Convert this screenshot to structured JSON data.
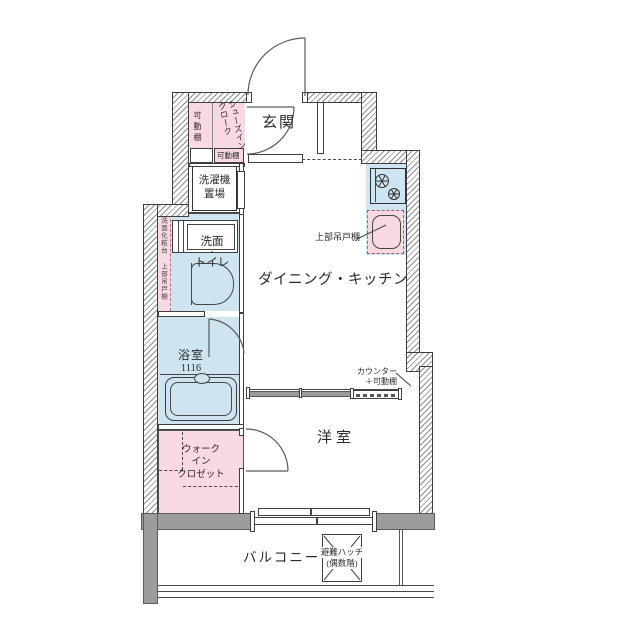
{
  "colors": {
    "room_blue": "#cfe4f1",
    "room_pink": "#f7d8e3",
    "wall_gray": "#9c9c9c",
    "line_dark": "#474747"
  },
  "labels": {
    "entrance": "玄関",
    "shoes_cloak_line1": "シューズイン",
    "shoes_cloak_line2": "クローク",
    "movable_shelf_vertical": "可動棚",
    "movable_shelf_box": "可動棚",
    "washer_line1": "洗濯機",
    "washer_line2": "置場",
    "vanity_strip": "洗面化粧台",
    "toilet_upper_cabinet_strip": "上部吊戸棚",
    "washroom_line1": "洗面",
    "washroom_dot": "・",
    "washroom_line2": "トイレ",
    "bathroom": "浴室",
    "bathroom_size": "1116",
    "dining_kitchen": "ダイニング・キッチン",
    "kitchen_upper_cabinet": "上部吊戸棚",
    "counter_line1": "カウンター",
    "counter_line2": "＋可動棚",
    "western_room": "洋室",
    "wic_line1": "ウォーク",
    "wic_line2": "イン",
    "wic_line3": "クロゼット",
    "balcony": "バルコニー",
    "hatch_line1": "避難ハッチ",
    "hatch_line2": "(偶数階)"
  }
}
